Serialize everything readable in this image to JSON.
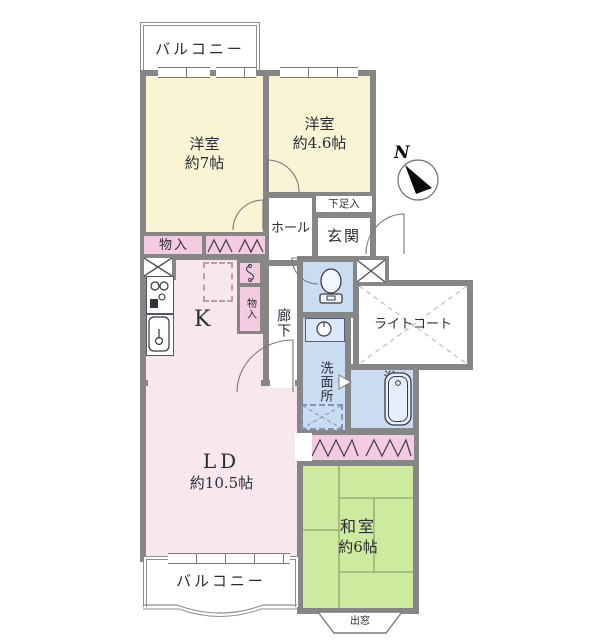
{
  "floorplan": {
    "compass": {
      "north_label": "N"
    },
    "balconies": {
      "top": "バルコニー",
      "bottom": "バルコニー"
    },
    "rooms": {
      "western_7": {
        "name": "洋室",
        "size": "約7帖"
      },
      "western_46": {
        "name": "洋室",
        "size": "約4.6帖"
      },
      "entrance": {
        "label": "玄関"
      },
      "shoe_storage": {
        "label": "下足入"
      },
      "hall": {
        "label": "ホール"
      },
      "corridor": {
        "label": "廊下"
      },
      "kitchen": {
        "label": "K"
      },
      "living_dining": {
        "name": "LD",
        "size": "約10.5帖"
      },
      "japanese_room": {
        "name": "和室",
        "size": "約6帖"
      },
      "washroom": {
        "label": "洗面所"
      },
      "bathroom": {
        "label": "浴室"
      },
      "light_court": {
        "label": "ライトコート"
      },
      "storage_upper": {
        "label": "物入"
      },
      "storage_corridor": {
        "label": "物入"
      },
      "bay_window": {
        "label": "出窓"
      }
    },
    "colors": {
      "wall": "#868686",
      "western": "#faf3d4",
      "lk": "#f9e7ee",
      "closet": "#f5cbe2",
      "water": "#cadcf2",
      "tatami": "#cdea9f",
      "text": "#2b2b33"
    },
    "icons": [
      "compass-icon",
      "toilet-icon",
      "washbasin-icon",
      "bathtub-icon",
      "gas-stove-icon",
      "kitchen-sink-icon",
      "water-heater-icon",
      "pipe-shaft-icon",
      "folding-door-icon",
      "refrigerator-space",
      "washing-machine-space",
      "door-swing-icon",
      "bay-window"
    ]
  }
}
